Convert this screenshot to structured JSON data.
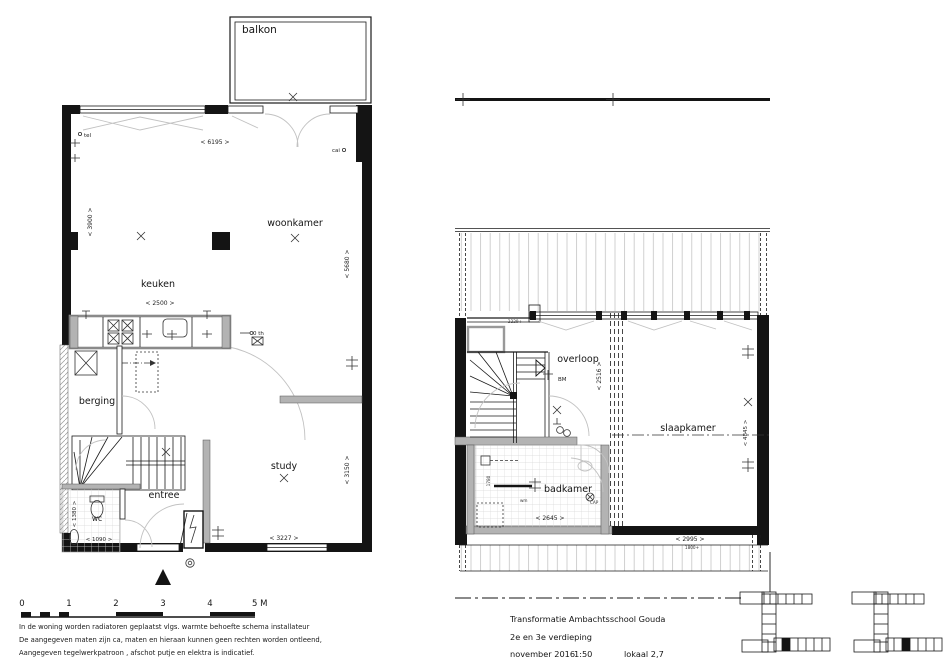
{
  "colors": {
    "line": "#141414",
    "grey_wall": "#b3b3b3",
    "light_line": "#c2c2c2",
    "paper": "#ffffff"
  },
  "left_plan": {
    "rooms": {
      "balkon": "balkon",
      "woonkamer": "woonkamer",
      "keuken": "keuken",
      "berging": "berging",
      "entree": "entree",
      "study": "study",
      "wc": "wc"
    },
    "dims": {
      "top": "< 6195 >",
      "left": "< 3900 >",
      "right_upper": "< 5680 >",
      "right_lower": "< 3150 >",
      "keuken": "< 2500 >",
      "bottom": "< 3227 >",
      "wc_height": "< 1380 >",
      "wc_width": "< 1090 >"
    },
    "annotations": {
      "tel": "tel",
      "cai": "cai",
      "thermostat": "0 th"
    }
  },
  "right_plan": {
    "rooms": {
      "overloop": "overloop",
      "slaapkamer": "slaapkamer",
      "badkamer": "badkamer"
    },
    "dims": {
      "overloop": "< 2516 >",
      "badkamer_w": "< 2645 >",
      "badkamer_h": "1780",
      "slaapkamer_w": "< 2995 >",
      "slaapkamer_h": "< 4845 >",
      "level_low": "1800+",
      "level_stair": "2229+"
    },
    "annotations": {
      "bm": "BM",
      "wm": "wm",
      "cap": "CAP"
    }
  },
  "scalebar": {
    "ticks": [
      "0",
      "1",
      "2",
      "3",
      "4",
      "5 M"
    ]
  },
  "notes": {
    "line1": "In de woning worden radiatoren geplaatst vlgs. warmte behoefte schema installateur",
    "line2": "De aangegeven maten zijn ca, maten en hieraan kunnen geen rechten worden ontleend,",
    "line3": "Aangegeven tegelwerkpatroon , afschot putje en elektra is indicatief."
  },
  "titleblock": {
    "project": "Transformatie Ambachtsschool Gouda",
    "floor": "2e en 3e verdieping",
    "date": "november 2016",
    "scale": "1:50",
    "room_ref": "lokaal 2,7"
  }
}
